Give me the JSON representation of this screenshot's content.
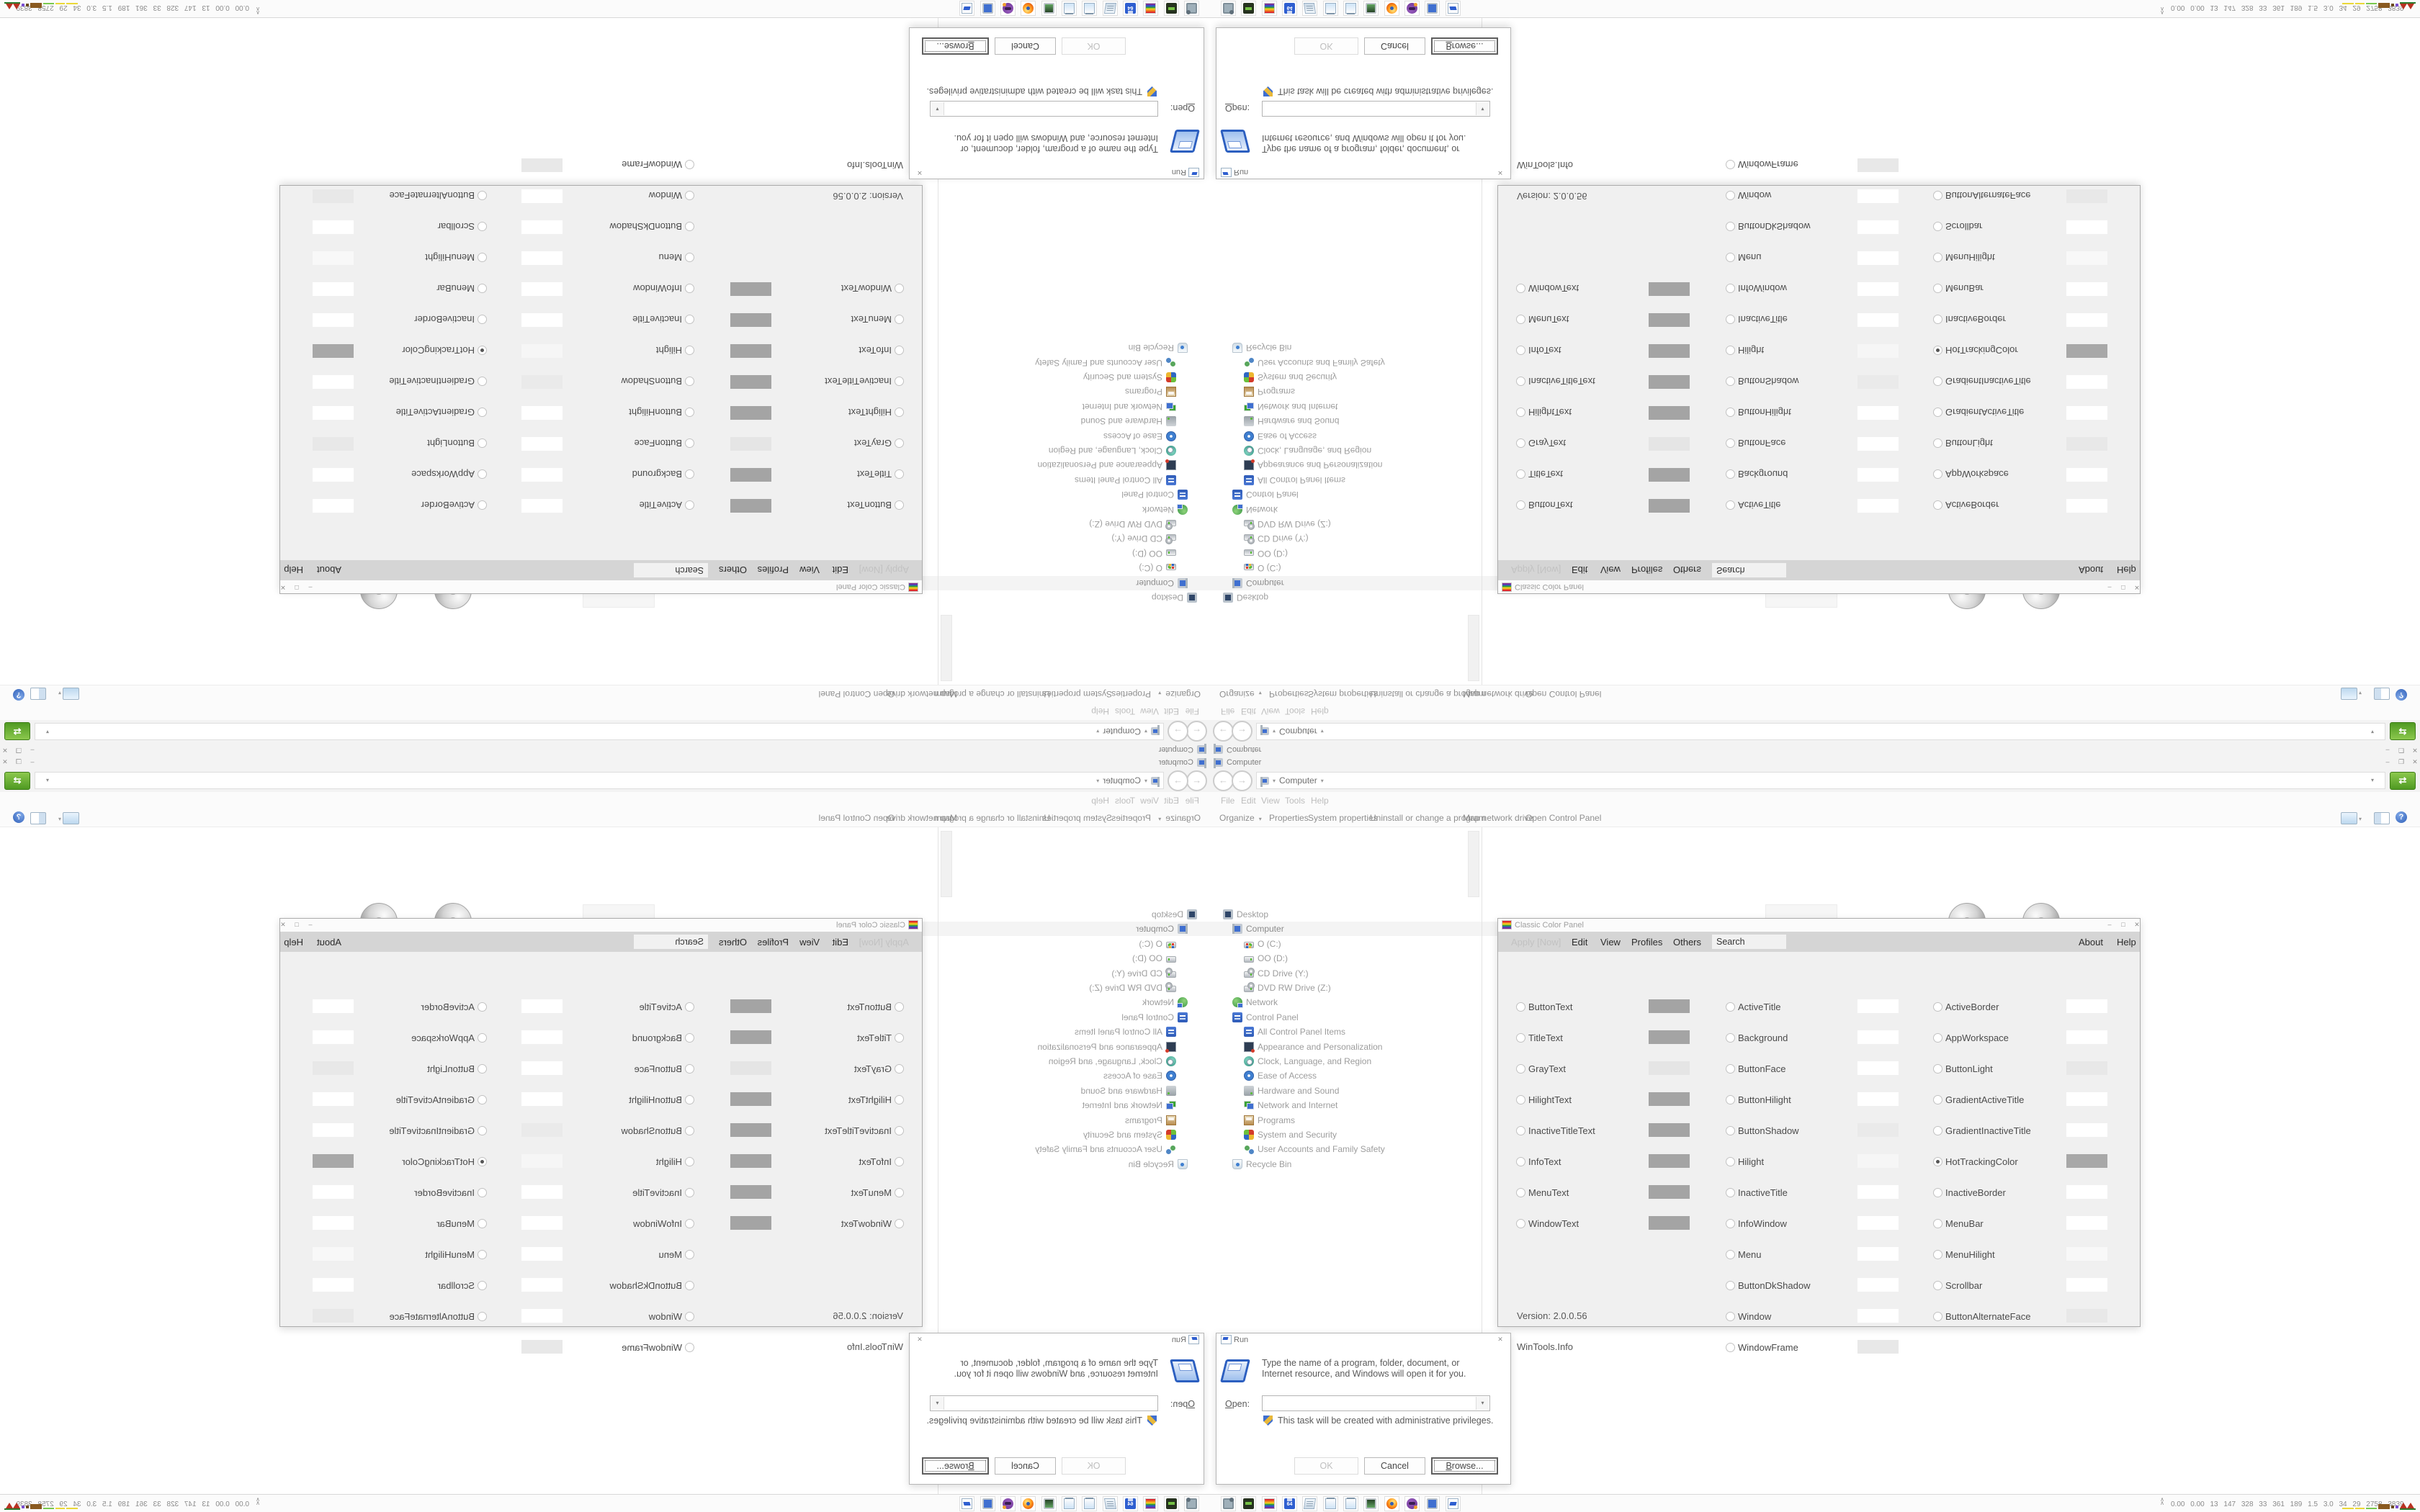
{
  "screen": {
    "background": "#ffffff",
    "note_layout": "desktop screenshot mirrored into four quadrants"
  },
  "explorer": {
    "title": "Computer",
    "window_controls": {
      "minimize": "–",
      "restore": "❐",
      "close": "✕"
    },
    "back_glyph": "←",
    "forward_glyph": "→",
    "breadcrumb": {
      "location": "Computer",
      "caret": "▾"
    },
    "go_glyph": "⇄",
    "menu_items": [
      "File",
      "Edit",
      "View",
      "Tools",
      "Help"
    ],
    "toolbar_items": [
      "Organize",
      "Properties",
      "System properties",
      "Uninstall or change a program",
      "Map network drive",
      "Open Control Panel"
    ],
    "help_glyph": "?",
    "tree": [
      {
        "label": "Desktop",
        "level": 0,
        "icon": "desktop"
      },
      {
        "label": "Computer",
        "level": 1,
        "icon": "computer",
        "selected": true
      },
      {
        "label": "O (C:)",
        "level": 2,
        "icon": "os-drive"
      },
      {
        "label": "OO (D:)",
        "level": 2,
        "icon": "drive"
      },
      {
        "label": "CD Drive (Y:)",
        "level": 2,
        "icon": "cd-drive"
      },
      {
        "label": "DVD RW Drive (Z:)",
        "level": 2,
        "icon": "cd-drive"
      },
      {
        "label": "Network",
        "level": 1,
        "icon": "network"
      },
      {
        "label": "Control Panel",
        "level": 1,
        "icon": "control-panel"
      },
      {
        "label": "All Control Panel Items",
        "level": 2,
        "icon": "control-panel"
      },
      {
        "label": "Appearance and Personalization",
        "level": 2,
        "icon": "appearance"
      },
      {
        "label": "Clock, Language, and Region",
        "level": 2,
        "icon": "clock-region"
      },
      {
        "label": "Ease of Access",
        "level": 2,
        "icon": "ease"
      },
      {
        "label": "Hardware and Sound",
        "level": 2,
        "icon": "hardware"
      },
      {
        "label": "Network and Internet",
        "level": 2,
        "icon": "network-internet"
      },
      {
        "label": "Programs",
        "level": 2,
        "icon": "programs"
      },
      {
        "label": "System and Security",
        "level": 2,
        "icon": "system-security"
      },
      {
        "label": "User Accounts and Family Safety",
        "level": 2,
        "icon": "users"
      },
      {
        "label": "Recycle Bin",
        "level": 1,
        "icon": "recycle"
      }
    ],
    "drives": [
      {
        "label": "O (C:)",
        "type": "os",
        "selected": true
      },
      {
        "label": "OO (D:)",
        "type": "plain"
      },
      {
        "label": "CD Drive (Y:)",
        "type": "cd"
      },
      {
        "label": "DVD RW Drive (Z:)",
        "type": "dvd",
        "badge": "DVD"
      }
    ]
  },
  "color_panel": {
    "title": "Classic Color Panel",
    "window_controls": {
      "minimize": "–",
      "maximize": "□",
      "close": "✕"
    },
    "menu_left": [
      {
        "label": "Apply [Now]",
        "disabled": true
      },
      {
        "label": "Edit"
      },
      {
        "label": "View"
      },
      {
        "label": "Profiles"
      },
      {
        "label": "Others"
      }
    ],
    "search_value": "Search",
    "menu_right": [
      "About",
      "Help"
    ],
    "version": "Version: 2.0.0.56",
    "site": "WinTools.Info",
    "rows": [
      {
        "c1": {
          "label": "ButtonText",
          "swatch": "#a4a4a4"
        },
        "c2": {
          "label": "ActiveTitle",
          "swatch": "#ffffff"
        },
        "c3": {
          "label": "ActiveBorder",
          "swatch": "#ffffff"
        }
      },
      {
        "c1": {
          "label": "TitleText",
          "swatch": "#a4a4a4"
        },
        "c2": {
          "label": "Background",
          "swatch": "#ffffff"
        },
        "c3": {
          "label": "AppWorkspace",
          "swatch": "#ffffff"
        }
      },
      {
        "c1": {
          "label": "GrayText",
          "swatch": "#e5e5e5"
        },
        "c2": {
          "label": "ButtonFace",
          "swatch": "#ffffff"
        },
        "c3": {
          "label": "ButtonLight",
          "swatch": "#e8e8e8"
        }
      },
      {
        "c1": {
          "label": "HilightText",
          "swatch": "#a4a4a4"
        },
        "c2": {
          "label": "ButtonHilight",
          "swatch": "#ffffff"
        },
        "c3": {
          "label": "GradientActiveTitle",
          "swatch": "#ffffff"
        }
      },
      {
        "c1": {
          "label": "InactiveTitleText",
          "swatch": "#a4a4a4"
        },
        "c2": {
          "label": "ButtonShadow",
          "swatch": "#eaeaea"
        },
        "c3": {
          "label": "GradientInactiveTitle",
          "swatch": "#ffffff"
        }
      },
      {
        "c1": {
          "label": "InfoText",
          "swatch": "#a4a4a4"
        },
        "c2": {
          "label": "Hilight",
          "swatch": "#f6f6f6"
        },
        "c3": {
          "label": "HotTrackingColor",
          "swatch": "#a8a8a8",
          "selected": true
        }
      },
      {
        "c1": {
          "label": "MenuText",
          "swatch": "#a4a4a4"
        },
        "c2": {
          "label": "InactiveTitle",
          "swatch": "#ffffff"
        },
        "c3": {
          "label": "InactiveBorder",
          "swatch": "#ffffff"
        }
      },
      {
        "c1": {
          "label": "WindowText",
          "swatch": "#a4a4a4"
        },
        "c2": {
          "label": "InfoWindow",
          "swatch": "#ffffff"
        },
        "c3": {
          "label": "MenuBar",
          "swatch": "#ffffff"
        }
      },
      {
        "c2": {
          "label": "Menu",
          "swatch": "#ffffff"
        },
        "c3": {
          "label": "MenuHilight",
          "swatch": "#f8f8f8"
        }
      },
      {
        "c2": {
          "label": "ButtonDkShadow",
          "swatch": "#ffffff"
        },
        "c3": {
          "label": "Scrollbar",
          "swatch": "#ffffff"
        }
      },
      {
        "c1": {
          "text": "Version: 2.0.0.56"
        },
        "c2": {
          "label": "Window",
          "swatch": "#ffffff"
        },
        "c3": {
          "label": "ButtonAlternateFace",
          "swatch": "#e8e8e8"
        }
      },
      {
        "c1": {
          "text": "WinTools.Info"
        },
        "c2": {
          "label": "WindowFrame",
          "swatch": "#e8e8e8"
        }
      }
    ]
  },
  "run_dialog": {
    "title": "Run",
    "close_glyph": "✕",
    "message": "Type the name of a program, folder, document, or Internet resource, and Windows will open it for you.",
    "open_label_mnemonic": "O",
    "open_label_rest": "pen:",
    "open_value": "",
    "combo_caret": "▾",
    "admin_note": "This task will be created with administrative privileges.",
    "buttons": [
      {
        "label": "OK",
        "disabled": true
      },
      {
        "label": "Cancel"
      },
      {
        "mnemonic": "B",
        "label": "rowse...",
        "focused": true
      }
    ]
  },
  "taskbar": {
    "icons": [
      {
        "name": "display-settings"
      },
      {
        "name": "drive-tool"
      },
      {
        "name": "rainbow-color-panel"
      },
      {
        "name": "floppy-64",
        "glyph": "64"
      },
      {
        "name": "text-scroll"
      },
      {
        "name": "notepad"
      },
      {
        "name": "notepad-2"
      },
      {
        "name": "terminal-monitor"
      },
      {
        "name": "firefox"
      },
      {
        "name": "media-purple"
      },
      {
        "name": "computer-monitor"
      },
      {
        "name": "run"
      }
    ],
    "tray": {
      "expander_glyph": "∧",
      "stats": [
        "0.00",
        "0.00",
        "13",
        "147",
        "328",
        "33",
        "361",
        "189",
        "1.5",
        "3.0",
        "34",
        "29",
        "2758",
        "3839"
      ],
      "graph": [
        {
          "kind": "line",
          "color": "#ead838",
          "w": 16
        },
        {
          "kind": "line",
          "color": "#ead838",
          "w": 13
        },
        {
          "kind": "line",
          "color": "#79c94e",
          "w": 15
        },
        {
          "kind": "bar",
          "color": "#8a5a20",
          "w": 16,
          "h": 7
        },
        {
          "kind": "dot",
          "color": "#6a4a1e",
          "w": 4
        },
        {
          "kind": "dot",
          "color": "#7a4fd0",
          "w": 4
        },
        {
          "kind": "peaks",
          "color": "#b83222",
          "base": "#2d7a2d",
          "w": 22
        }
      ]
    }
  }
}
